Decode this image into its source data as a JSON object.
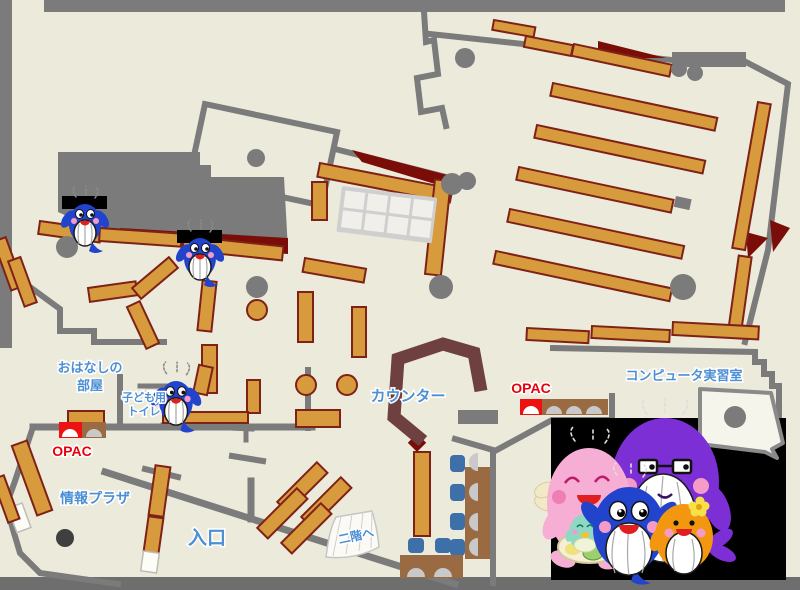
{
  "labels": {
    "storytelling_room_line1": "おはなしの",
    "storytelling_room_line2": "部屋",
    "kids_toilet_line1": "子ども用",
    "kids_toilet_line2": "トイレ",
    "opac": "OPAC",
    "info_plaza": "情報プラザ",
    "entrance": "入口",
    "counter": "カウンター",
    "computer_room": "コンピュータ実習室",
    "to_second_floor": "二階へ"
  },
  "colors": {
    "floor": "#ECEADB",
    "wall": "#7B7B7B",
    "frameBottom": "#6E6E6E",
    "shelf": "#D79A3D",
    "shelfBorder": "#7E2117",
    "darkRed": "#7A0D08",
    "counter": "#6F4040",
    "deskBrown": "#9A6B42",
    "chairBlue": "#3D6FA8",
    "seatGray": "#C9C9C9",
    "gridFrame": "#CFCFCF",
    "gridCell": "#F0EFE9",
    "labelBlue": "#4D8FD5",
    "opacRed": "#E8000D",
    "whaleBlue": "#2244CC",
    "mascotPurple": "#7D2FD6",
    "mascotPink": "#F6AED4",
    "mascotOrange": "#F2970F",
    "mascotTeal": "#8FD8C4"
  }
}
